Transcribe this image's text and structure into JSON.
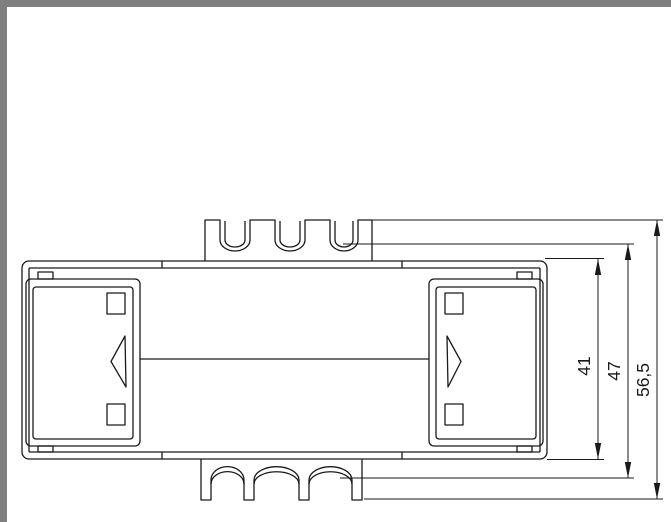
{
  "colors": {
    "frame": "#7f7f7f",
    "line": "#1a1a1a",
    "background": "#ffffff"
  },
  "drawing": {
    "kind": "technical-drawing-top-view",
    "dimensions": [
      {
        "label": "41"
      },
      {
        "label": "47"
      },
      {
        "label": "56,5"
      }
    ]
  }
}
